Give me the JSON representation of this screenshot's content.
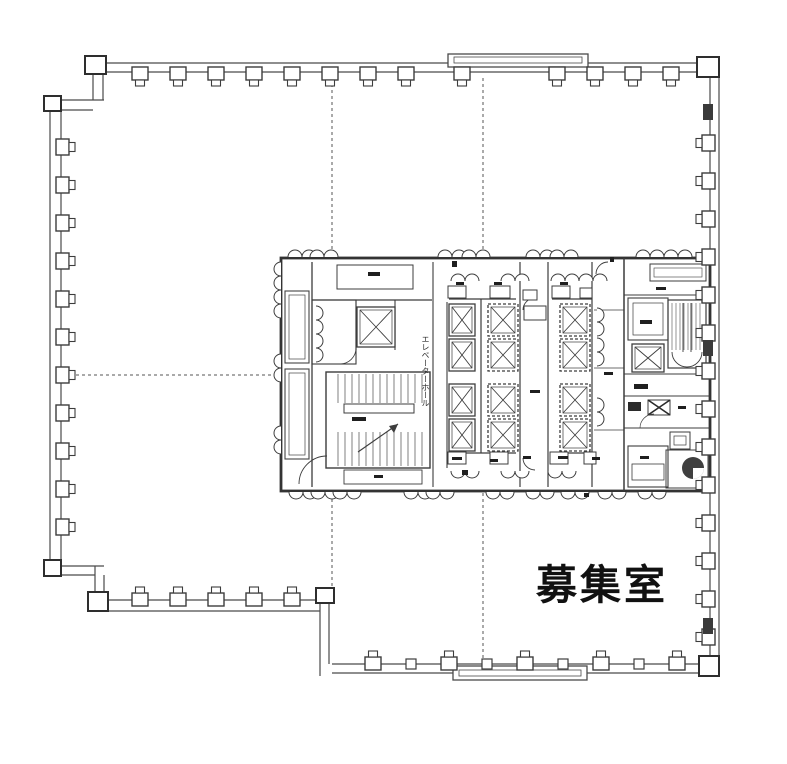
{
  "labels": {
    "vacant_room": "募集室",
    "elevator_hall": "エレベーターホール"
  },
  "colors": {
    "background": "#ffffff",
    "ink": "#3d3d3d",
    "ink_dark": "#1f1f1f"
  },
  "plan": {
    "columns": {
      "top": {
        "y": 72,
        "rot": 0,
        "x": [
          140,
          178,
          216,
          254,
          292,
          330,
          368,
          406,
          462,
          557,
          595,
          633,
          671
        ]
      },
      "left": {
        "x": 61,
        "rot": -90,
        "y": [
          147,
          185,
          223,
          261,
          299,
          337,
          375,
          413,
          451,
          489,
          527
        ]
      },
      "right": {
        "x": 710,
        "rot": 90,
        "y": [
          143,
          181,
          219,
          257,
          295,
          333,
          371,
          409,
          447,
          485,
          523,
          561,
          599,
          637
        ]
      },
      "bottom_left": {
        "y": 601,
        "rot": 180,
        "x": [
          140,
          178,
          216,
          254,
          292
        ]
      },
      "bottom_right_big": {
        "y": 665,
        "rot": 180,
        "x": [
          373,
          449,
          525,
          601,
          677
        ]
      },
      "bottom_right_small": {
        "y": 665,
        "rot": 180,
        "x": [
          411,
          487,
          563,
          639
        ]
      }
    },
    "jogs": [
      [
        708,
        112
      ],
      [
        708,
        348
      ],
      [
        708,
        626
      ]
    ],
    "scallops": [
      {
        "x": 302,
        "y": 257,
        "rot": 0
      },
      {
        "x": 324,
        "y": 257,
        "rot": 0
      },
      {
        "x": 452,
        "y": 257,
        "rot": 0
      },
      {
        "x": 476,
        "y": 257,
        "rot": 0
      },
      {
        "x": 540,
        "y": 257,
        "rot": 0
      },
      {
        "x": 564,
        "y": 257,
        "rot": 0
      },
      {
        "x": 650,
        "y": 257,
        "rot": 0
      },
      {
        "x": 678,
        "y": 257,
        "rot": 0
      },
      {
        "x": 465,
        "y": 281,
        "rot": 0
      },
      {
        "x": 515,
        "y": 281,
        "rot": 0
      },
      {
        "x": 565,
        "y": 281,
        "rot": 0
      },
      {
        "x": 593,
        "y": 281,
        "rot": 0
      },
      {
        "x": 303,
        "y": 492,
        "rot": 180
      },
      {
        "x": 325,
        "y": 492,
        "rot": 180
      },
      {
        "x": 347,
        "y": 492,
        "rot": 180
      },
      {
        "x": 418,
        "y": 492,
        "rot": 180
      },
      {
        "x": 440,
        "y": 492,
        "rot": 180
      },
      {
        "x": 500,
        "y": 492,
        "rot": 180
      },
      {
        "x": 540,
        "y": 492,
        "rot": 180
      },
      {
        "x": 575,
        "y": 492,
        "rot": 180
      },
      {
        "x": 612,
        "y": 492,
        "rot": 180
      },
      {
        "x": 652,
        "y": 492,
        "rot": 180
      },
      {
        "x": 465,
        "y": 471,
        "rot": 180
      },
      {
        "x": 515,
        "y": 471,
        "rot": 180
      },
      {
        "x": 562,
        "y": 471,
        "rot": 180
      },
      {
        "x": 281,
        "y": 276,
        "rot": -90
      },
      {
        "x": 281,
        "y": 304,
        "rot": -90
      },
      {
        "x": 281,
        "y": 368,
        "rot": -90
      },
      {
        "x": 281,
        "y": 440,
        "rot": -90
      },
      {
        "x": 316,
        "y": 320,
        "rot": 90
      },
      {
        "x": 316,
        "y": 348,
        "rot": 90
      },
      {
        "x": 597,
        "y": 322,
        "rot": 90
      },
      {
        "x": 597,
        "y": 352,
        "rot": 90
      },
      {
        "x": 597,
        "y": 412,
        "rot": 90
      }
    ],
    "elevators": [
      {
        "x": 449,
        "y": 304,
        "w": 26,
        "h": 32,
        "dashed": false
      },
      {
        "x": 449,
        "y": 339,
        "w": 26,
        "h": 32,
        "dashed": false
      },
      {
        "x": 449,
        "y": 384,
        "w": 26,
        "h": 32,
        "dashed": false
      },
      {
        "x": 449,
        "y": 419,
        "w": 26,
        "h": 32,
        "dashed": false
      },
      {
        "x": 488,
        "y": 304,
        "w": 30,
        "h": 32,
        "dashed": true
      },
      {
        "x": 488,
        "y": 339,
        "w": 30,
        "h": 32,
        "dashed": true
      },
      {
        "x": 488,
        "y": 384,
        "w": 30,
        "h": 32,
        "dashed": true
      },
      {
        "x": 488,
        "y": 419,
        "w": 30,
        "h": 32,
        "dashed": true
      },
      {
        "x": 560,
        "y": 304,
        "w": 30,
        "h": 32,
        "dashed": true
      },
      {
        "x": 560,
        "y": 339,
        "w": 30,
        "h": 32,
        "dashed": true
      },
      {
        "x": 560,
        "y": 384,
        "w": 30,
        "h": 32,
        "dashed": true
      },
      {
        "x": 560,
        "y": 419,
        "w": 30,
        "h": 32,
        "dashed": true
      },
      {
        "x": 357,
        "y": 307,
        "w": 38,
        "h": 40,
        "dashed": false
      },
      {
        "x": 632,
        "y": 344,
        "w": 32,
        "h": 28,
        "dashed": false
      }
    ],
    "stubs": [
      [
        448,
        286,
        18,
        12
      ],
      [
        490,
        286,
        20,
        12
      ],
      [
        523,
        290,
        14,
        10
      ],
      [
        552,
        286,
        18,
        12
      ],
      [
        580,
        288,
        12,
        10
      ],
      [
        448,
        452,
        18,
        12
      ],
      [
        490,
        452,
        18,
        12
      ],
      [
        550,
        452,
        18,
        12
      ],
      [
        584,
        452,
        12,
        12
      ],
      [
        524,
        306,
        22,
        14
      ]
    ],
    "ticks": [
      [
        368,
        272,
        12,
        4
      ],
      [
        374,
        475,
        9,
        3
      ],
      [
        456,
        282,
        8,
        3
      ],
      [
        494,
        282,
        8,
        3
      ],
      [
        560,
        282,
        8,
        3
      ],
      [
        452,
        457,
        10,
        3
      ],
      [
        490,
        459,
        8,
        3
      ],
      [
        523,
        456,
        8,
        3
      ],
      [
        558,
        456,
        10,
        3
      ],
      [
        592,
        457,
        8,
        3
      ],
      [
        530,
        390,
        10,
        3
      ],
      [
        604,
        372,
        9,
        3
      ],
      [
        656,
        287,
        10,
        3
      ],
      [
        640,
        320,
        12,
        4
      ],
      [
        634,
        384,
        14,
        5
      ],
      [
        678,
        406,
        8,
        3
      ],
      [
        640,
        456,
        9,
        3
      ],
      [
        352,
        417,
        14,
        4
      ],
      [
        462,
        470,
        6,
        5
      ],
      [
        452,
        261,
        5,
        6
      ],
      [
        610,
        257,
        4,
        5
      ],
      [
        584,
        493,
        5,
        4
      ]
    ]
  }
}
